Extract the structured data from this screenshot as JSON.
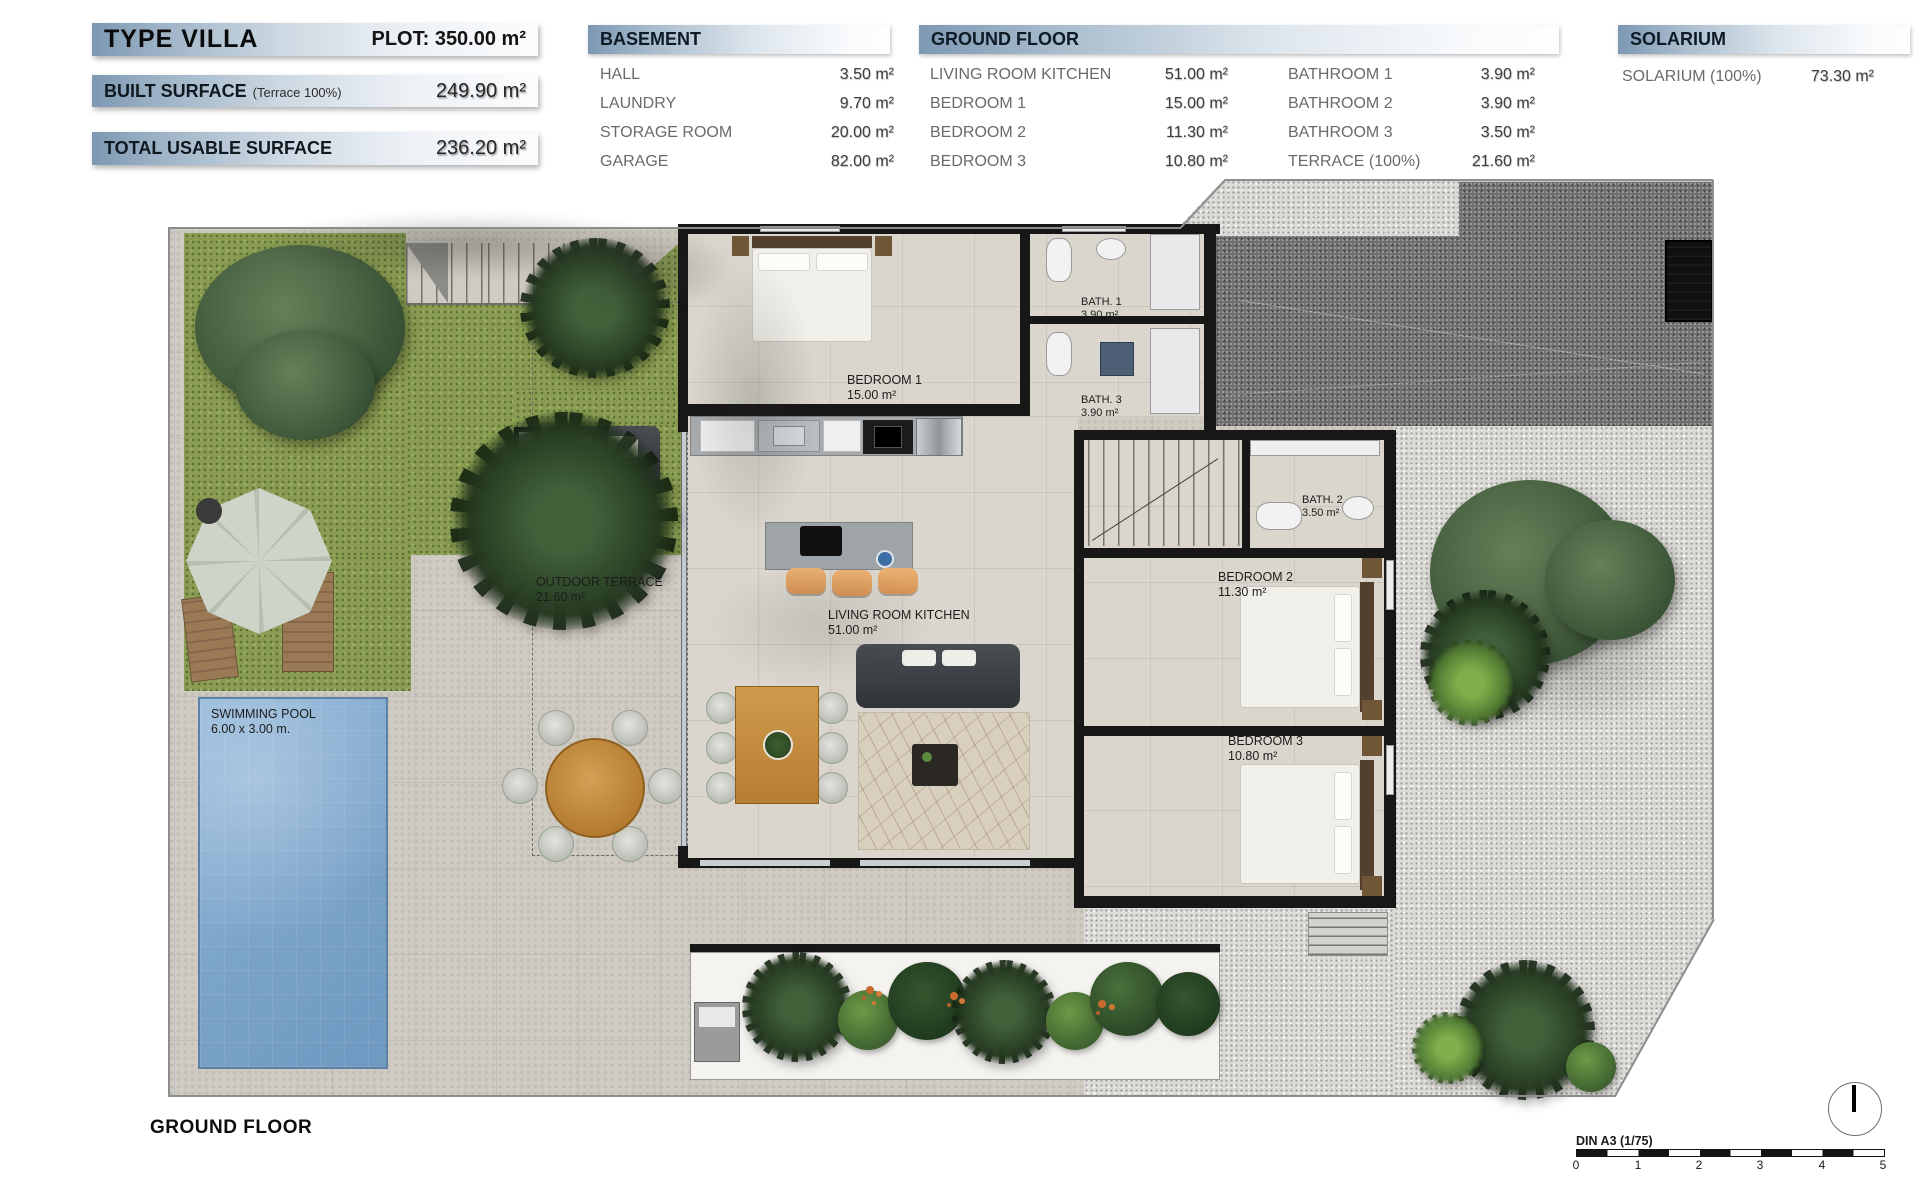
{
  "header": {
    "type_label": "TYPE VILLA",
    "plot": "PLOT: 350.00 m²",
    "built": {
      "label": "BUILT SURFACE",
      "note": "(Terrace 100%)",
      "value": "249.90 m²"
    },
    "usable": {
      "label": "TOTAL USABLE SURFACE",
      "value": "236.20 m²"
    }
  },
  "legend": {
    "basement": {
      "title": "BASEMENT",
      "rows": [
        {
          "name": "HALL",
          "value": "3.50 m²"
        },
        {
          "name": "LAUNDRY",
          "value": "9.70 m²"
        },
        {
          "name": "STORAGE ROOM",
          "value": "20.00 m²"
        },
        {
          "name": "GARAGE",
          "value": "82.00 m²"
        }
      ]
    },
    "ground_floor": {
      "title": "GROUND FLOOR",
      "col_a": [
        {
          "name": "LIVING ROOM KITCHEN",
          "value": "51.00 m²"
        },
        {
          "name": "BEDROOM 1",
          "value": "15.00 m²"
        },
        {
          "name": "BEDROOM 2",
          "value": "11.30 m²"
        },
        {
          "name": "BEDROOM 3",
          "value": "10.80 m²"
        }
      ],
      "col_b": [
        {
          "name": "BATHROOM 1",
          "value": "3.90 m²"
        },
        {
          "name": "BATHROOM 2",
          "value": "3.90 m²"
        },
        {
          "name": "BATHROOM 3",
          "value": "3.50 m²"
        },
        {
          "name": "TERRACE (100%)",
          "value": "21.60 m²"
        }
      ]
    },
    "solarium": {
      "title": "SOLARIUM",
      "rows": [
        {
          "name": "SOLARIUM (100%)",
          "value": "73.30 m²"
        }
      ]
    }
  },
  "plan": {
    "rooms": {
      "bedroom1": {
        "name": "BEDROOM 1",
        "area": "15.00 m²"
      },
      "bath1": {
        "name": "BATH. 1",
        "area": "3.90 m²"
      },
      "bath3": {
        "name": "BATH. 3",
        "area": "3.90 m²"
      },
      "bath2": {
        "name": "BATH. 2",
        "area": "3.50 m²"
      },
      "bedroom2": {
        "name": "BEDROOM 2",
        "area": "11.30 m²"
      },
      "bedroom3": {
        "name": "BEDROOM 3",
        "area": "10.80 m²"
      },
      "living": {
        "name": "LIVING ROOM KITCHEN",
        "area": "51.00 m²"
      },
      "terrace": {
        "name": "OUTDOOR TERRACE",
        "area": "21.60 m²"
      },
      "pool": {
        "name": "SWIMMING POOL",
        "area": "6.00 x 3.00 m."
      }
    }
  },
  "footer": {
    "floor_label": "GROUND FLOOR",
    "scale_label": "DIN A3 (1/75)",
    "scale_ticks": [
      "0",
      "1",
      "2",
      "3",
      "4",
      "5"
    ]
  },
  "colors": {
    "legend_bar": "#7d98b3",
    "wall": "#171717",
    "paving": "#cfcbc2",
    "interior_floor": "#dad6cd",
    "grass": "#8a9d52",
    "pool": "#7aa3c9",
    "gravel_light": "#dcdbd7",
    "gravel_dark": "#6f6f6f",
    "hedge_green": "#3c5c30",
    "wood": "#c08a42",
    "flower_orange": "#c96a2d"
  }
}
